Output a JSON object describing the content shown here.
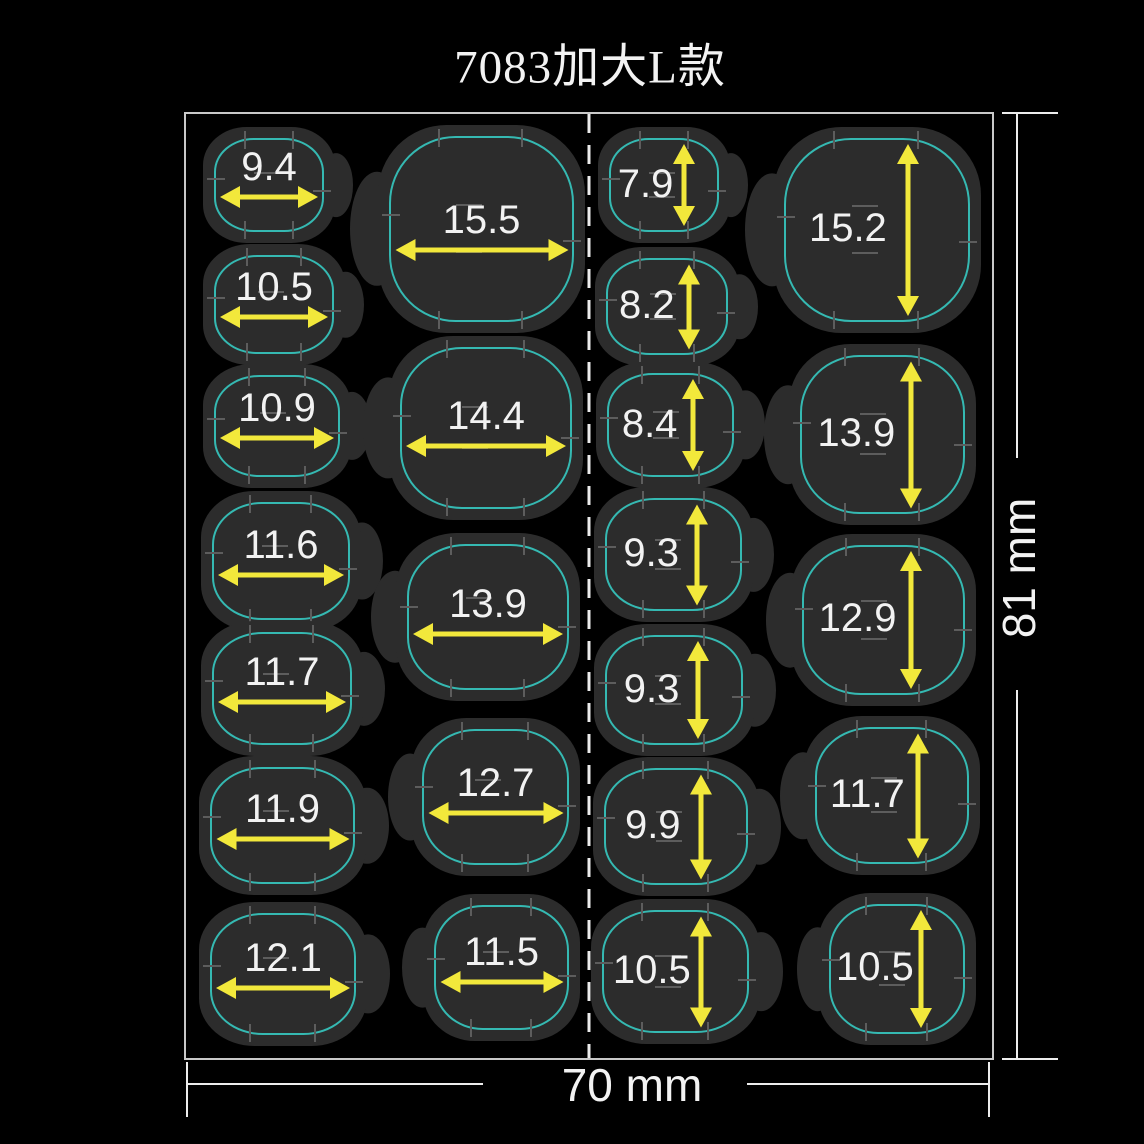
{
  "title": "7083加大L款",
  "dimensions": {
    "width_label": "70 mm",
    "height_label": "81 mm"
  },
  "colors": {
    "background": "#000000",
    "blob": "#2c2c2c",
    "outline_cyan": "#35b9b2",
    "arrow_yellow": "#f2e83b",
    "text": "#f2f2f2",
    "frame": "#c9c9c9",
    "frame_bright": "#ececec",
    "tick": "#5d5d5d"
  },
  "sheet": {
    "box": {
      "x": 184,
      "y": 112,
      "w": 806,
      "h": 944
    },
    "stickers": [
      {
        "value": "9.4",
        "orientation": "horizontal",
        "tab": "right",
        "x": 212,
        "y": 136,
        "w": 110,
        "h": 94
      },
      {
        "value": "10.5",
        "orientation": "horizontal",
        "tab": "right",
        "x": 212,
        "y": 253,
        "w": 120,
        "h": 99
      },
      {
        "value": "10.9",
        "orientation": "horizontal",
        "tab": "right",
        "x": 212,
        "y": 373,
        "w": 126,
        "h": 102
      },
      {
        "value": "11.6",
        "orientation": "horizontal",
        "tab": "right",
        "x": 210,
        "y": 500,
        "w": 138,
        "h": 118
      },
      {
        "value": "11.7",
        "orientation": "horizontal",
        "tab": "right",
        "x": 210,
        "y": 630,
        "w": 140,
        "h": 113
      },
      {
        "value": "11.9",
        "orientation": "horizontal",
        "tab": "right",
        "x": 208,
        "y": 765,
        "w": 145,
        "h": 117
      },
      {
        "value": "12.1",
        "orientation": "horizontal",
        "tab": "right",
        "x": 208,
        "y": 911,
        "w": 146,
        "h": 122
      },
      {
        "value": "15.5",
        "orientation": "horizontal",
        "tab": "left",
        "x": 387,
        "y": 134,
        "w": 185,
        "h": 186
      },
      {
        "value": "14.4",
        "orientation": "horizontal",
        "tab": "left",
        "x": 398,
        "y": 345,
        "w": 172,
        "h": 162
      },
      {
        "value": "13.9",
        "orientation": "horizontal",
        "tab": "left",
        "x": 405,
        "y": 542,
        "w": 162,
        "h": 146
      },
      {
        "value": "12.7",
        "orientation": "horizontal",
        "tab": "left",
        "x": 420,
        "y": 727,
        "w": 147,
        "h": 136
      },
      {
        "value": "11.5",
        "orientation": "horizontal",
        "tab": "left",
        "x": 432,
        "y": 903,
        "w": 135,
        "h": 125
      },
      {
        "value": "7.9",
        "orientation": "vertical",
        "tab": "right",
        "x": 607,
        "y": 136,
        "w": 110,
        "h": 94
      },
      {
        "value": "8.2",
        "orientation": "vertical",
        "tab": "right",
        "x": 604,
        "y": 256,
        "w": 122,
        "h": 97
      },
      {
        "value": "8.4",
        "orientation": "vertical",
        "tab": "right",
        "x": 605,
        "y": 371,
        "w": 127,
        "h": 104
      },
      {
        "value": "9.3",
        "orientation": "vertical",
        "tab": "right",
        "x": 603,
        "y": 496,
        "w": 137,
        "h": 113
      },
      {
        "value": "9.3",
        "orientation": "vertical",
        "tab": "right",
        "x": 603,
        "y": 633,
        "w": 138,
        "h": 110
      },
      {
        "value": "9.9",
        "orientation": "vertical",
        "tab": "right",
        "x": 602,
        "y": 766,
        "w": 144,
        "h": 117
      },
      {
        "value": "10.5",
        "orientation": "vertical",
        "tab": "right",
        "x": 600,
        "y": 908,
        "w": 147,
        "h": 123
      },
      {
        "value": "15.2",
        "orientation": "vertical",
        "tab": "left",
        "x": 782,
        "y": 136,
        "w": 186,
        "h": 184
      },
      {
        "value": "13.9",
        "orientation": "vertical",
        "tab": "left",
        "x": 798,
        "y": 353,
        "w": 165,
        "h": 159
      },
      {
        "value": "12.9",
        "orientation": "vertical",
        "tab": "left",
        "x": 800,
        "y": 543,
        "w": 163,
        "h": 150
      },
      {
        "value": "11.7",
        "orientation": "vertical",
        "tab": "left",
        "x": 813,
        "y": 725,
        "w": 154,
        "h": 137
      },
      {
        "value": "10.5",
        "orientation": "vertical",
        "tab": "left",
        "x": 827,
        "y": 902,
        "w": 136,
        "h": 130
      }
    ]
  }
}
